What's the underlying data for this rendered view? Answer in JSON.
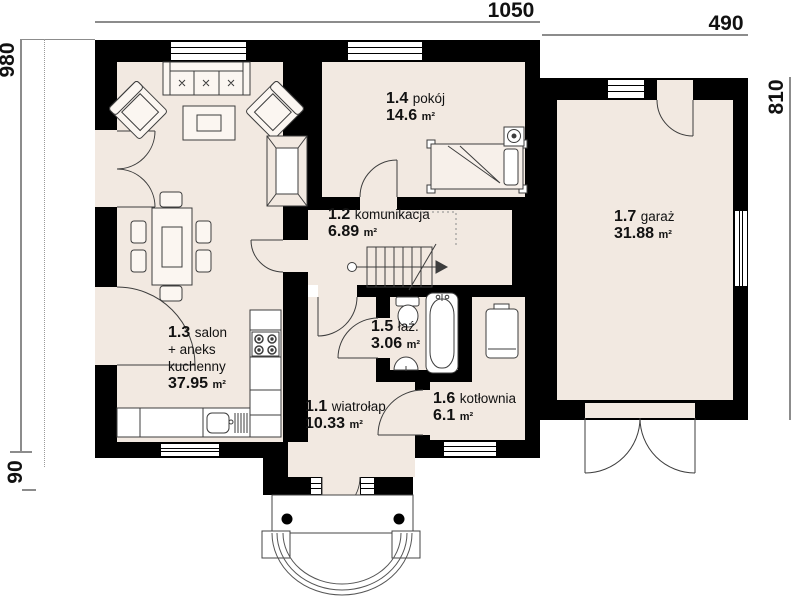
{
  "dimensions": {
    "top_main": "1050",
    "top_garage": "490",
    "left_height": "980",
    "left_porch": "90",
    "right_garage": "810"
  },
  "rooms": [
    {
      "num": "1.1",
      "name": "wiatrołap",
      "area": "10.33",
      "unit": "m²"
    },
    {
      "num": "1.2",
      "name": "komunikacja",
      "area": "6.89",
      "unit": "m²"
    },
    {
      "num": "1.3",
      "name": "salon\n+ aneks\nkuchenny",
      "area": "37.95",
      "unit": "m²"
    },
    {
      "num": "1.4",
      "name": "pokój",
      "area": "14.6",
      "unit": "m²"
    },
    {
      "num": "1.5",
      "name": "łaź.",
      "area": "3.06",
      "unit": "m²"
    },
    {
      "num": "1.6",
      "name": "kotłownia",
      "area": "6.1",
      "unit": "m²"
    },
    {
      "num": "1.7",
      "name": "garaż",
      "area": "31.88",
      "unit": "m²"
    }
  ],
  "colors": {
    "wall": "#000000",
    "floor": "#f2e9e1",
    "outline": "#3d3d3d",
    "dimension": "#8c8c8c"
  }
}
